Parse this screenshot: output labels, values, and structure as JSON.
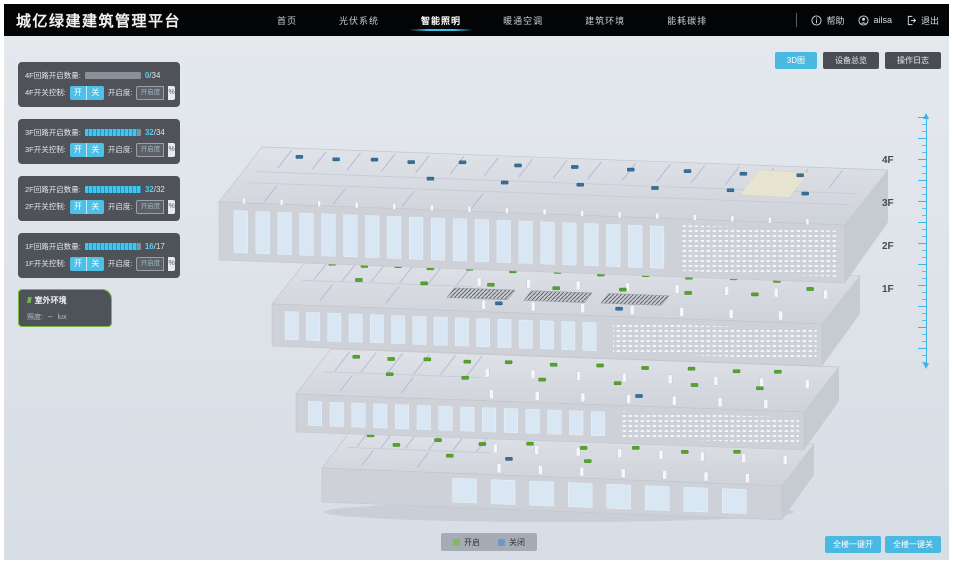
{
  "app": {
    "title": "城亿绿建建筑管理平台"
  },
  "nav": {
    "items": [
      {
        "label": "首页",
        "active": false
      },
      {
        "label": "光伏系统",
        "active": false
      },
      {
        "label": "智能照明",
        "active": true
      },
      {
        "label": "暖通空调",
        "active": false
      },
      {
        "label": "建筑环境",
        "active": false
      },
      {
        "label": "能耗碳排",
        "active": false
      }
    ]
  },
  "header": {
    "help_label": "帮助",
    "user_name": "ailsa",
    "logout_label": "退出"
  },
  "view_buttons": [
    {
      "label": "3D图",
      "active": true
    },
    {
      "label": "设备总览",
      "active": false
    },
    {
      "label": "操作日志",
      "active": false
    }
  ],
  "panels": [
    {
      "count_label": "4F回路开启数量:",
      "on": "0",
      "total": "/34",
      "progress": 0,
      "switch_label": "4F开关控制:",
      "btn_on": "开",
      "btn_off": "关",
      "dim_label": "开启度:",
      "dim_placeholder": "开启度",
      "unit": "%"
    },
    {
      "count_label": "3F回路开启数量:",
      "on": "32",
      "total": "/34",
      "progress": 94,
      "switch_label": "3F开关控制:",
      "btn_on": "开",
      "btn_off": "关",
      "dim_label": "开启度:",
      "dim_placeholder": "开启度",
      "unit": "%"
    },
    {
      "count_label": "2F回路开启数量:",
      "on": "32",
      "total": "/32",
      "progress": 100,
      "switch_label": "2F开关控制:",
      "btn_on": "开",
      "btn_off": "关",
      "dim_label": "开启度:",
      "dim_placeholder": "开启度",
      "unit": "%"
    },
    {
      "count_label": "1F回路开启数量:",
      "on": "16",
      "total": "/17",
      "progress": 94,
      "switch_label": "1F开关控制:",
      "btn_on": "开",
      "btn_off": "关",
      "dim_label": "开启度:",
      "dim_placeholder": "开启度",
      "unit": "%"
    }
  ],
  "outdoor": {
    "title": "室外环境",
    "icon": "///",
    "metric_label": "照度:",
    "metric_value": "--",
    "metric_unit": "lux"
  },
  "floor_axis": {
    "labels": [
      "4F",
      "3F",
      "2F",
      "1F"
    ]
  },
  "legend": {
    "items": [
      {
        "label": "开启",
        "color": "#84ba5a"
      },
      {
        "label": "关闭",
        "color": "#7094cc"
      }
    ]
  },
  "global_buttons": [
    {
      "label": "全楼一键开"
    },
    {
      "label": "全楼一键关"
    }
  ],
  "building": {
    "marker_colors": {
      "on": "#55a32a",
      "off": "#33719c"
    },
    "floors": [
      {
        "label": "4F",
        "markers": [
          [
            0.07,
            0.15,
            "off"
          ],
          [
            0.13,
            0.17,
            "off"
          ],
          [
            0.19,
            0.15,
            "off"
          ],
          [
            0.25,
            0.17,
            "off"
          ],
          [
            0.33,
            0.14,
            "off"
          ],
          [
            0.42,
            0.16,
            "off"
          ],
          [
            0.51,
            0.15,
            "off"
          ],
          [
            0.6,
            0.16,
            "off"
          ],
          [
            0.69,
            0.15,
            "off"
          ],
          [
            0.78,
            0.16,
            "off"
          ],
          [
            0.87,
            0.15,
            "off"
          ],
          [
            0.3,
            0.45,
            "off"
          ],
          [
            0.42,
            0.47,
            "off"
          ],
          [
            0.54,
            0.46,
            "off"
          ],
          [
            0.66,
            0.47,
            "off"
          ],
          [
            0.78,
            0.46,
            "off"
          ],
          [
            0.9,
            0.47,
            "off"
          ]
        ]
      },
      {
        "label": "3F",
        "markers": [
          [
            0.05,
            0.14,
            "on"
          ],
          [
            0.11,
            0.16,
            "on"
          ],
          [
            0.17,
            0.14,
            "on"
          ],
          [
            0.23,
            0.16,
            "on"
          ],
          [
            0.3,
            0.14,
            "on"
          ],
          [
            0.38,
            0.16,
            "on"
          ],
          [
            0.46,
            0.14,
            "on"
          ],
          [
            0.54,
            0.16,
            "on"
          ],
          [
            0.62,
            0.14,
            "on"
          ],
          [
            0.7,
            0.16,
            "on"
          ],
          [
            0.78,
            0.14,
            "on"
          ],
          [
            0.86,
            0.16,
            "on"
          ],
          [
            0.12,
            0.45,
            "on"
          ],
          [
            0.24,
            0.47,
            "on"
          ],
          [
            0.36,
            0.45,
            "on"
          ],
          [
            0.48,
            0.47,
            "on"
          ],
          [
            0.6,
            0.45,
            "on"
          ],
          [
            0.72,
            0.47,
            "on"
          ],
          [
            0.84,
            0.45,
            "on"
          ],
          [
            0.93,
            0.3,
            "on"
          ],
          [
            0.4,
            0.82,
            "off"
          ],
          [
            0.62,
            0.84,
            "off"
          ]
        ]
      },
      {
        "label": "2F",
        "markers": [
          [
            0.06,
            0.15,
            "on"
          ],
          [
            0.13,
            0.17,
            "on"
          ],
          [
            0.2,
            0.15,
            "on"
          ],
          [
            0.28,
            0.17,
            "on"
          ],
          [
            0.36,
            0.15,
            "on"
          ],
          [
            0.45,
            0.17,
            "on"
          ],
          [
            0.54,
            0.15,
            "on"
          ],
          [
            0.63,
            0.17,
            "on"
          ],
          [
            0.72,
            0.15,
            "on"
          ],
          [
            0.81,
            0.17,
            "on"
          ],
          [
            0.89,
            0.15,
            "on"
          ],
          [
            0.15,
            0.5,
            "on"
          ],
          [
            0.3,
            0.52,
            "on"
          ],
          [
            0.45,
            0.5,
            "on"
          ],
          [
            0.6,
            0.52,
            "on"
          ],
          [
            0.75,
            0.5,
            "on"
          ],
          [
            0.88,
            0.52,
            "on"
          ],
          [
            0.66,
            0.78,
            "off"
          ]
        ]
      },
      {
        "label": "1F",
        "markers": [
          [
            0.05,
            0.2,
            "on"
          ],
          [
            0.12,
            0.4,
            "on"
          ],
          [
            0.2,
            0.25,
            "on"
          ],
          [
            0.3,
            0.3,
            "on"
          ],
          [
            0.4,
            0.25,
            "on"
          ],
          [
            0.52,
            0.3,
            "on"
          ],
          [
            0.63,
            0.25,
            "on"
          ],
          [
            0.74,
            0.3,
            "on"
          ],
          [
            0.85,
            0.25,
            "on"
          ],
          [
            0.25,
            0.6,
            "on"
          ],
          [
            0.55,
            0.6,
            "on"
          ],
          [
            0.38,
            0.62,
            "off"
          ]
        ]
      }
    ]
  }
}
